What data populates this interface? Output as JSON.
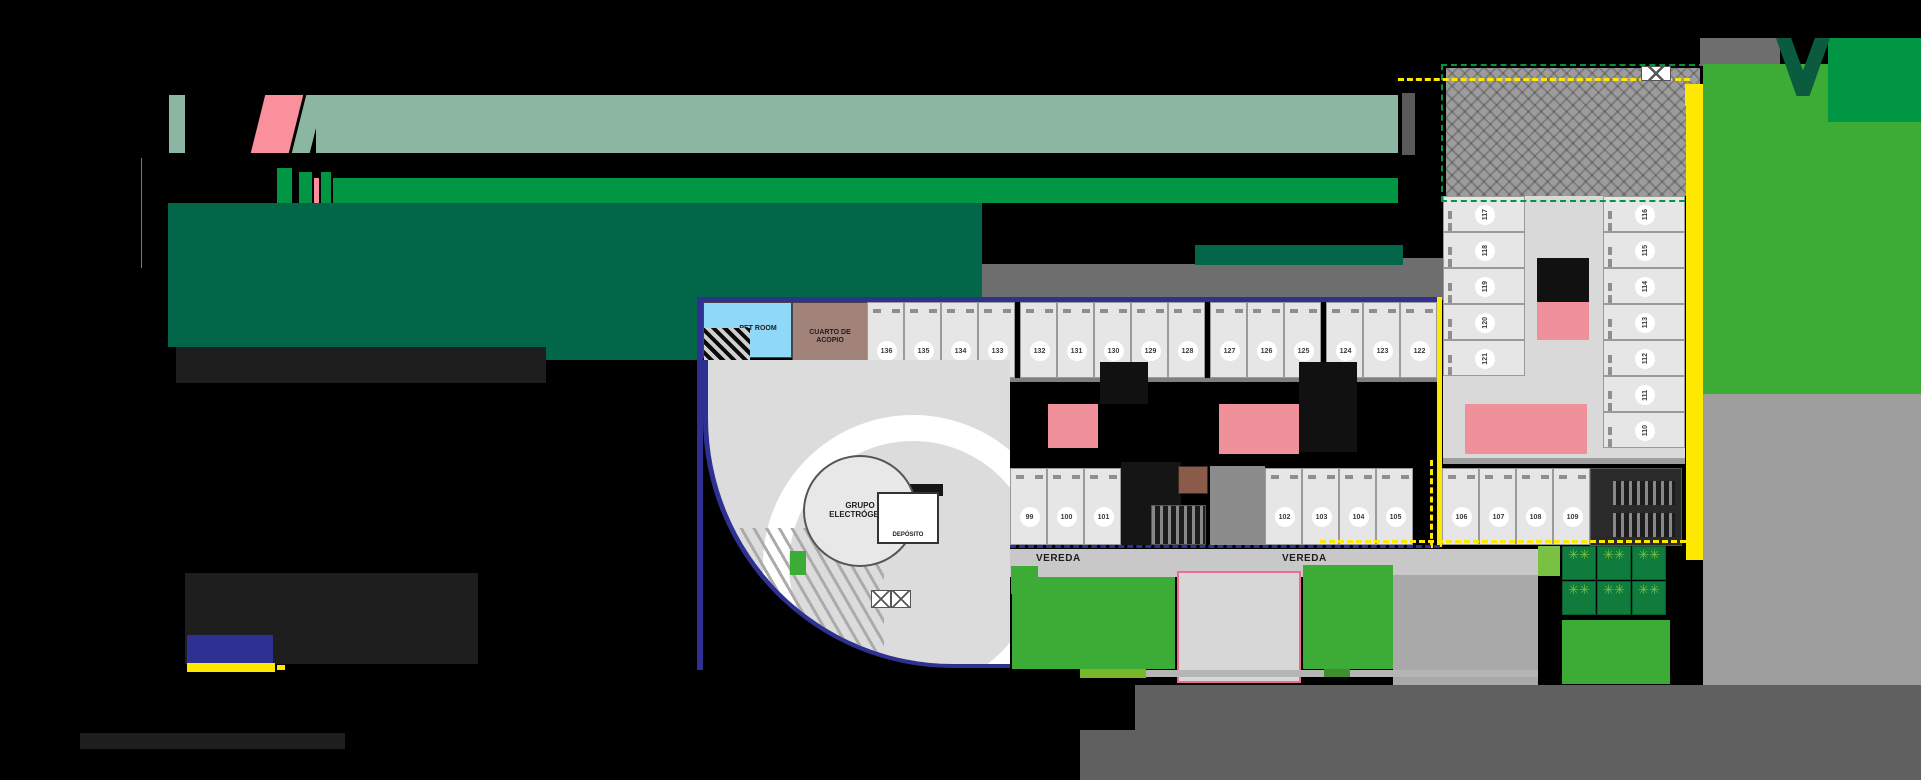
{
  "branding": {
    "sage_banner": "logo-banner",
    "accent_glyph": "110",
    "colors": {
      "sage": "#8CB6A2",
      "logo_pink": "#F9909B",
      "bright_green": "#009644",
      "dark_green": "#026749",
      "lawn_green": "#3CAC37",
      "lawn_bright": "#009644",
      "v_mark_green": "#0B5B3F",
      "navy": "#2E3192",
      "yellow": "#FFE800",
      "pink_room": "#F0909A",
      "patio_pink_border": "#EE6D8E",
      "blue_room": "#8FD8F7",
      "acopio_mauve": "#A2837A",
      "brown_room": "#8A5A4A",
      "road_gray": "#606060",
      "sidewalk_gray": "#C8C8C8",
      "roof_gray": "#9C9C9C",
      "tree_bed_green": "#0F7B3C",
      "tree_green": "#7AC143"
    }
  },
  "legend": {
    "boundary_chip_color": "#2E3192",
    "underline_color": "#FFE800"
  },
  "plan": {
    "labels": {
      "pet_room": "PET ROOM",
      "cuarto_acopio": "CUARTO DE ACOPIO",
      "grupo_electrogeno": "GRUPO ELECTRÓGENO",
      "deposito": "DEPÓSITO",
      "vereda_left": "VEREDA",
      "vereda_right": "VEREDA"
    },
    "stalls": {
      "top_row": [
        "136",
        "135",
        "134",
        "133",
        "132",
        "131",
        "130",
        "129",
        "128",
        "127",
        "126",
        "125",
        "124",
        "123",
        "122"
      ],
      "top_row_pillar_gaps_after": [
        3,
        8,
        11
      ],
      "bottom_left": [
        "99",
        "100",
        "101"
      ],
      "bottom_mid": [
        "102",
        "103",
        "104",
        "105"
      ],
      "bottom_right": [
        "106",
        "107",
        "108",
        "109"
      ],
      "right_block_west": [
        "117",
        "118",
        "119",
        "120",
        "121"
      ],
      "right_block_east": [
        "116",
        "115",
        "114",
        "113",
        "112",
        "111",
        "110"
      ]
    },
    "tree_planters": {
      "cols": 3,
      "rows": 2,
      "tree_glyph": "✳✳"
    }
  }
}
